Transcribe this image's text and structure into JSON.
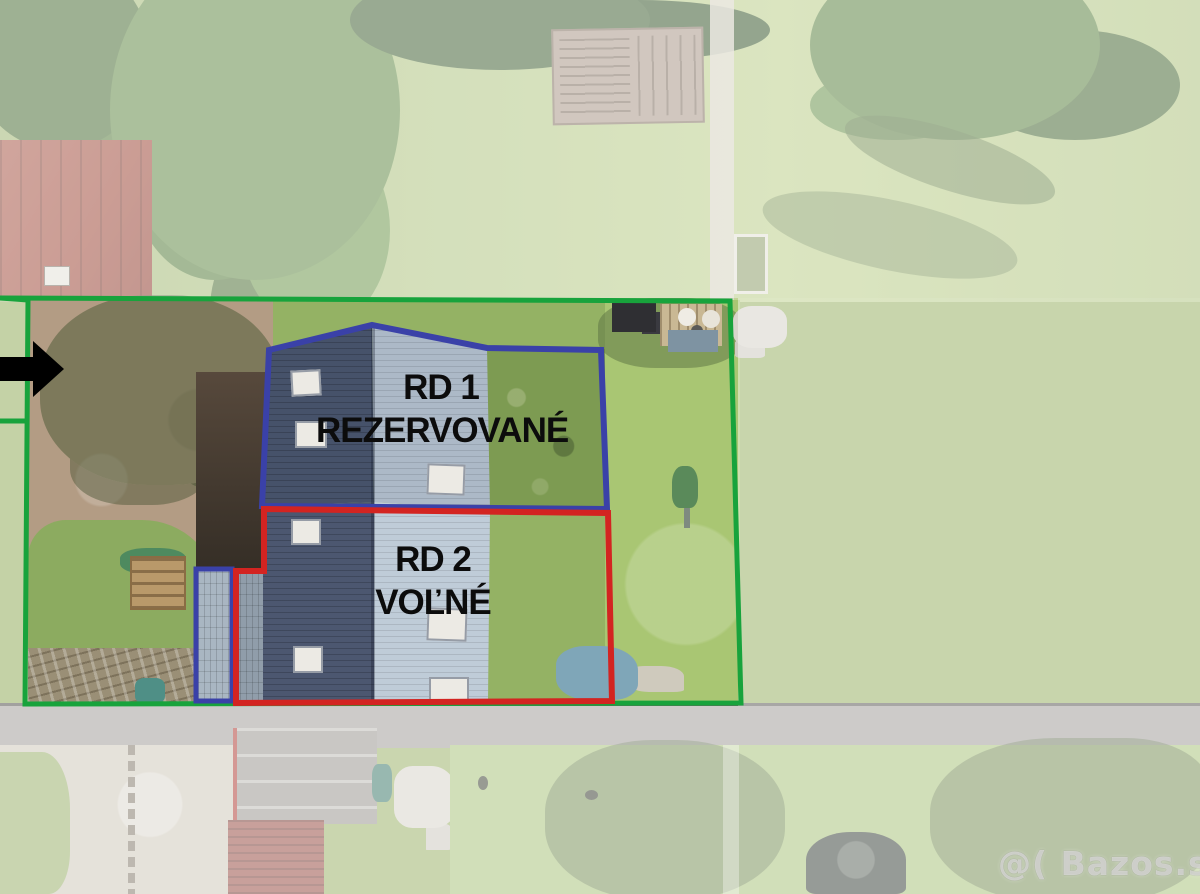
{
  "annotations": {
    "unit1": {
      "label_line1": "RD 1",
      "label_line2": "REZERVOVANÉ"
    },
    "unit2": {
      "label_line1": "RD 2",
      "label_line2": "VOĽNÉ"
    }
  },
  "watermark": {
    "text": "@( Bazos.sk"
  },
  "colors": {
    "boundary_green": "#18a33c",
    "unit1_outline_blue": "#3a41a8",
    "unit2_outline_red": "#d32421",
    "label_text": "#0c0c0c",
    "arrow_black": "#000000"
  }
}
